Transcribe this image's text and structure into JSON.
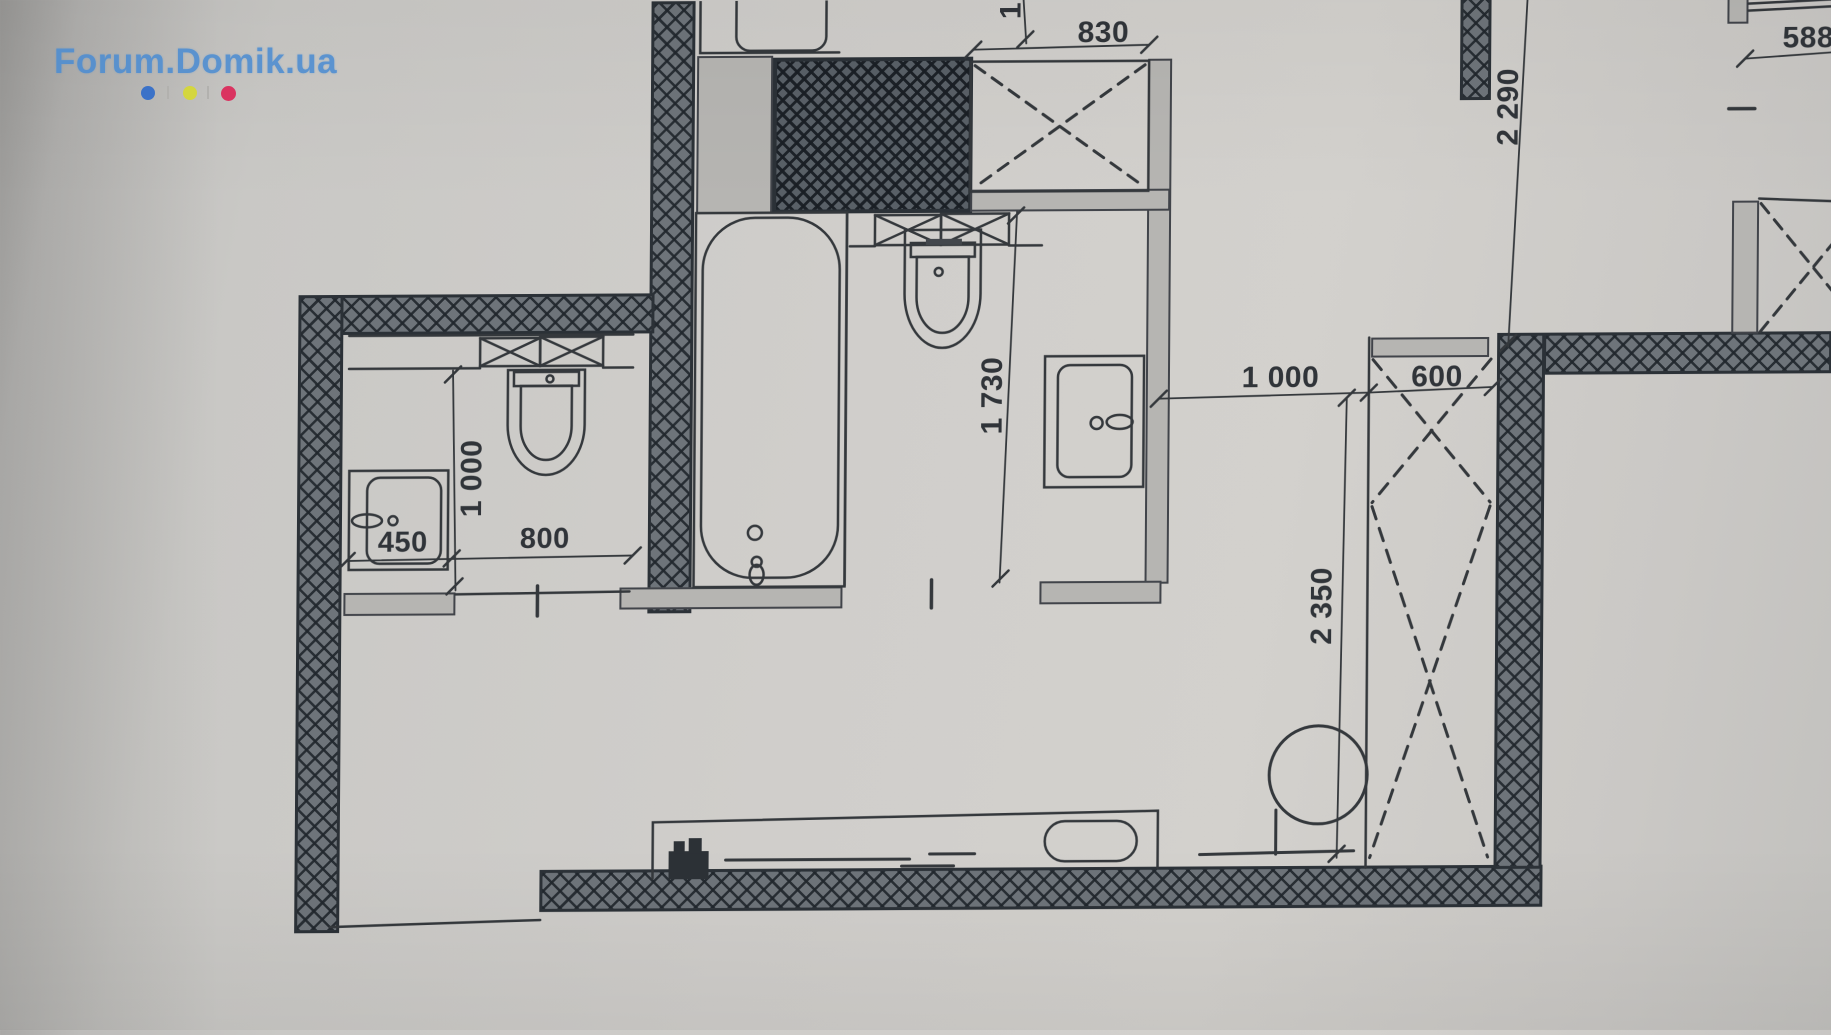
{
  "watermark": {
    "text": "Forum.Domik.ua",
    "dot_colors": [
      "#3b72c8",
      "#d4d63e",
      "#da3360"
    ]
  },
  "dimensions": {
    "washer_width": "830",
    "top_cut": "1",
    "right_offset": "588",
    "hall_length": "2 290",
    "opening_width": "1 000",
    "wardrobe_width": "600",
    "wardrobe_length": "2 350",
    "bath_wall_length": "1 730",
    "wc_length": "1 000",
    "basin_width": "450",
    "wc_width": "800"
  },
  "colors": {
    "paper": "#cdccc8",
    "ink": "#34383c",
    "wall_fill": "#6e747a",
    "wall_edge": "#2b3137",
    "light_wall": "#b6b5b2",
    "logo_blue": "#4d8dd2"
  }
}
